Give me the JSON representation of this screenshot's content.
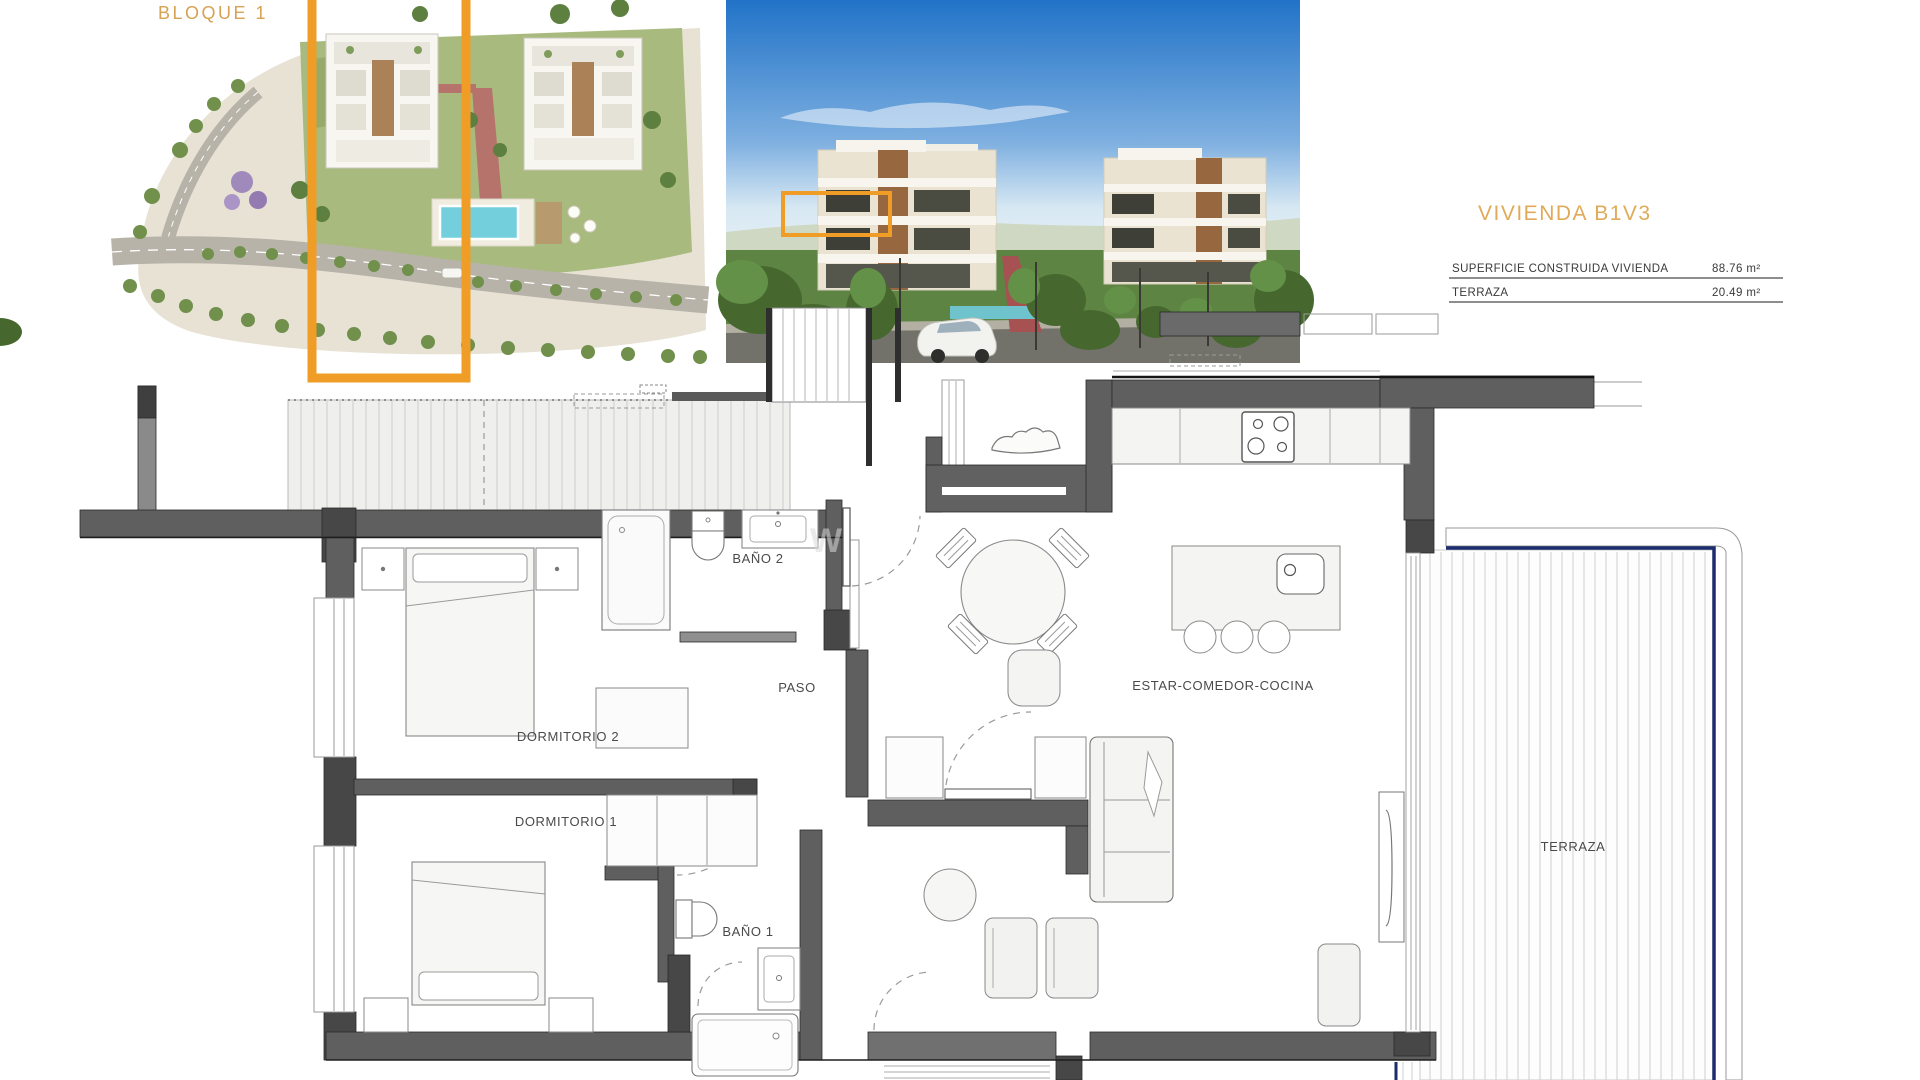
{
  "site_plan": {
    "block_label": "BLOQUE 1"
  },
  "unit_info": {
    "title": "VIVIENDA B1V3",
    "area_table": {
      "rows": [
        {
          "label": "SUPERFICIE CONSTRUIDA VIVIENDA",
          "value": "88.76 m²"
        },
        {
          "label": "TERRAZA",
          "value": "20.49 m²"
        }
      ]
    }
  },
  "floor_plan": {
    "watermark": "W",
    "rooms": [
      {
        "id": "bano-2",
        "label": "BAÑO 2"
      },
      {
        "id": "paso",
        "label": "PASO"
      },
      {
        "id": "dormitorio-2",
        "label": "DORMITORIO 2"
      },
      {
        "id": "dormitorio-1",
        "label": "DORMITORIO 1"
      },
      {
        "id": "bano-1",
        "label": "BAÑO 1"
      },
      {
        "id": "estar-comedor-cocina",
        "label": "ESTAR-COMEDOR-COCINA"
      },
      {
        "id": "terraza",
        "label": "TERRAZA"
      }
    ]
  },
  "colors": {
    "highlight_orange": "#EF9D26",
    "title_tan": "#DCA75A",
    "terrace_navy": "#1D2C6E",
    "wall_gray": "#5F5F5F"
  }
}
